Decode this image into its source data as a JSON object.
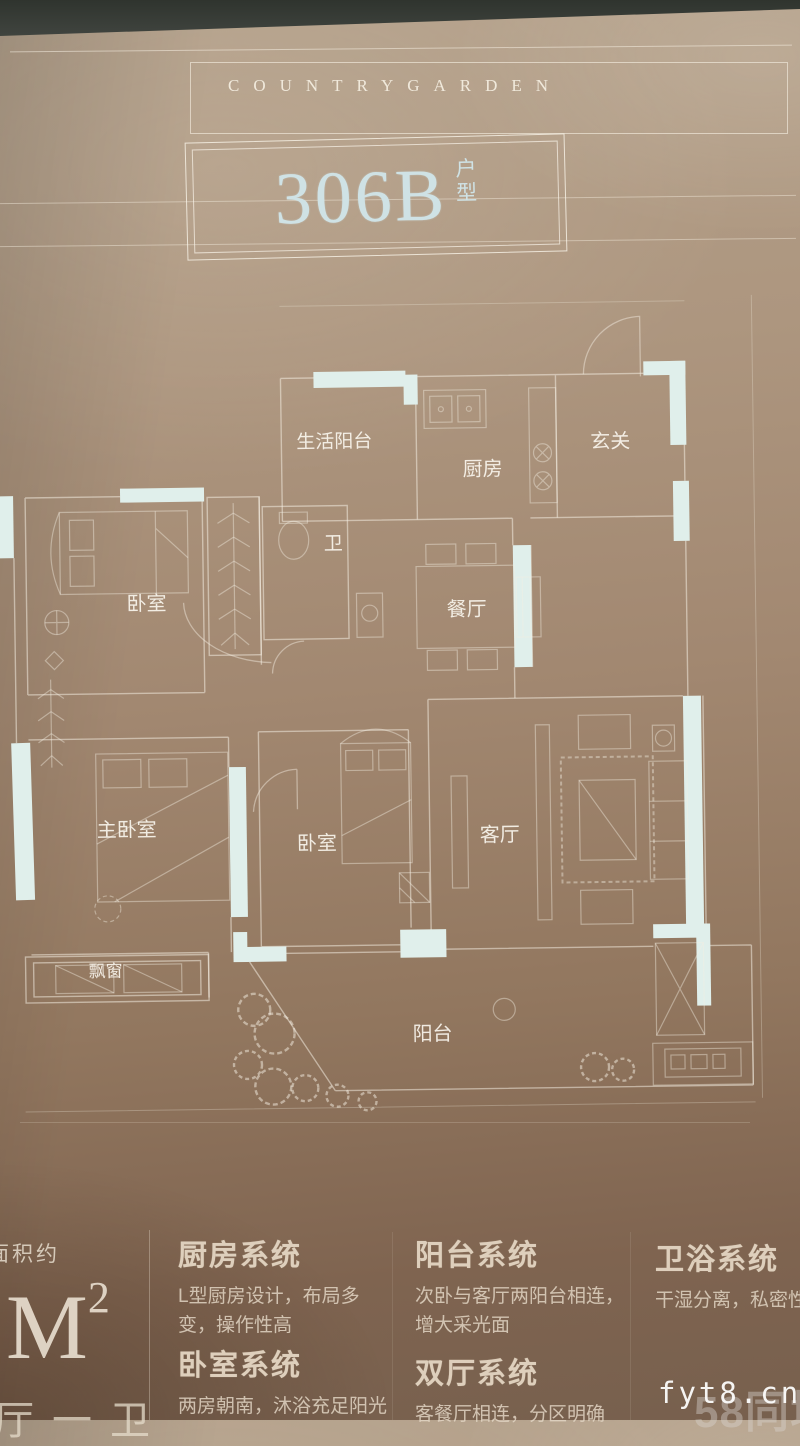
{
  "brand": "COUNTRYGARDEN",
  "unit": {
    "code": "306B",
    "suffix_top": "户",
    "suffix_bottom": "型"
  },
  "plan": {
    "rooms": {
      "service_balcony": "生活阳台",
      "kitchen": "厨房",
      "foyer": "玄关",
      "bedroom": "卧室",
      "bath": "卫",
      "dining": "餐厅",
      "master_bedroom": "主卧室",
      "bedroom2": "卧室",
      "living": "客厅",
      "bay_window": "飘窗",
      "balcony": "阳台"
    }
  },
  "info": {
    "area_label": "面积约",
    "area": {
      "digit": "8",
      "unit": "M",
      "sup": "2"
    },
    "layout_partial": "厅一卫",
    "columns": [
      {
        "title": "厨房系统",
        "desc": "L型厨房设计，布局多变，操作性高"
      },
      {
        "title": "卧室系统",
        "desc": "两房朝南，沐浴充足阳光"
      },
      {
        "title": "阳台系统",
        "desc": "次卧与客厅两阳台相连，增大采光面"
      },
      {
        "title": "双厅系统",
        "desc": "客餐厅相连，分区明确"
      },
      {
        "title": "卫浴系统",
        "desc": "干湿分离，私密性"
      }
    ]
  },
  "watermark": {
    "site": "fyt8.cn",
    "logo": "58同城"
  }
}
